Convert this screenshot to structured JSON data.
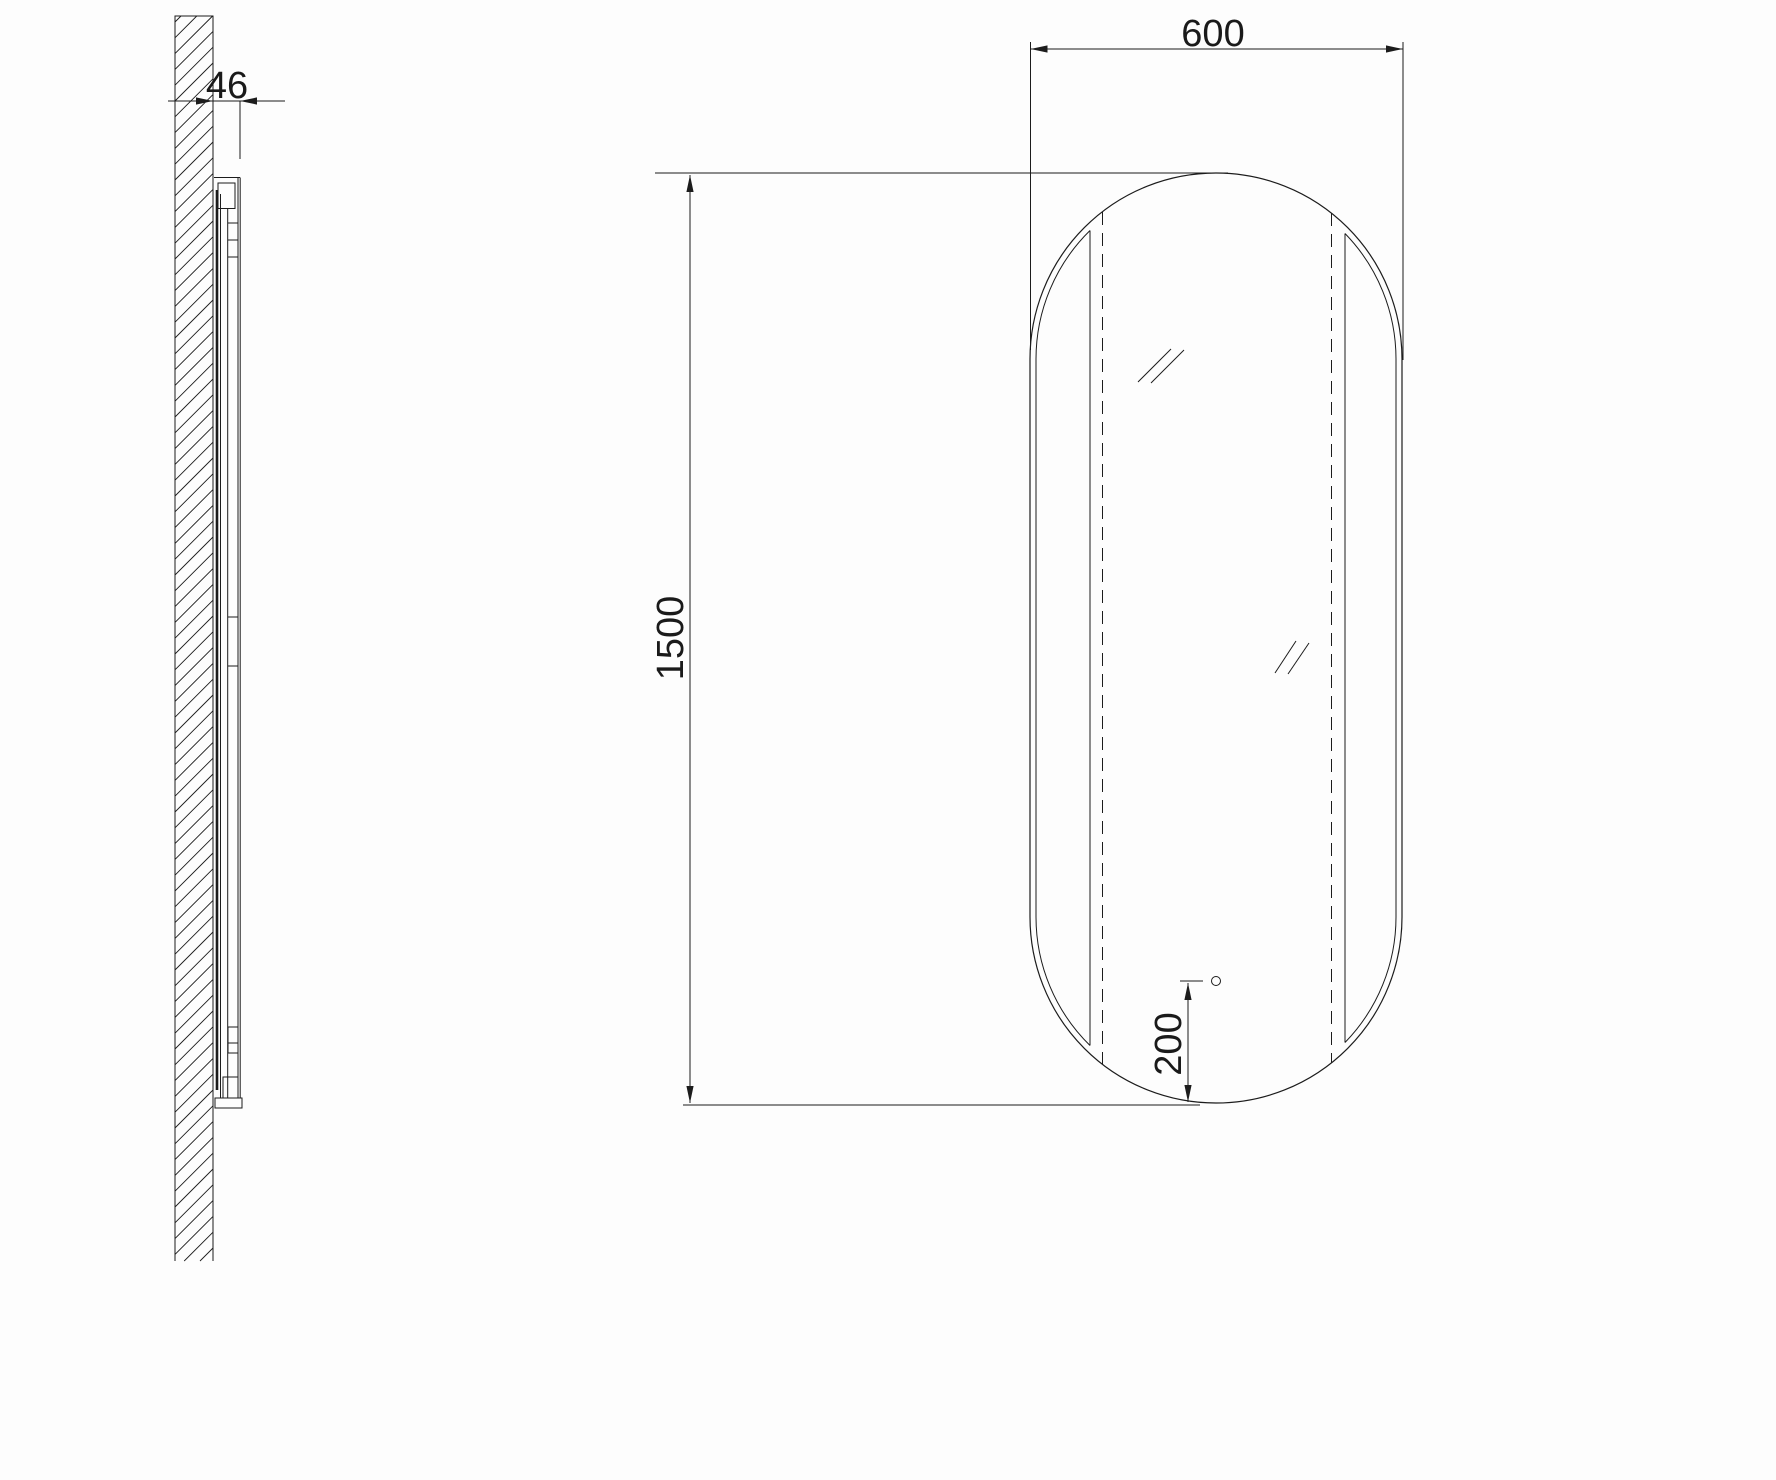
{
  "drawing": {
    "labels": {
      "depth": "46",
      "width": "600",
      "height": "1500",
      "sensor_offset": "200"
    },
    "colors": {
      "line": "#1c1c1c",
      "background": "#fdfdfd"
    }
  }
}
